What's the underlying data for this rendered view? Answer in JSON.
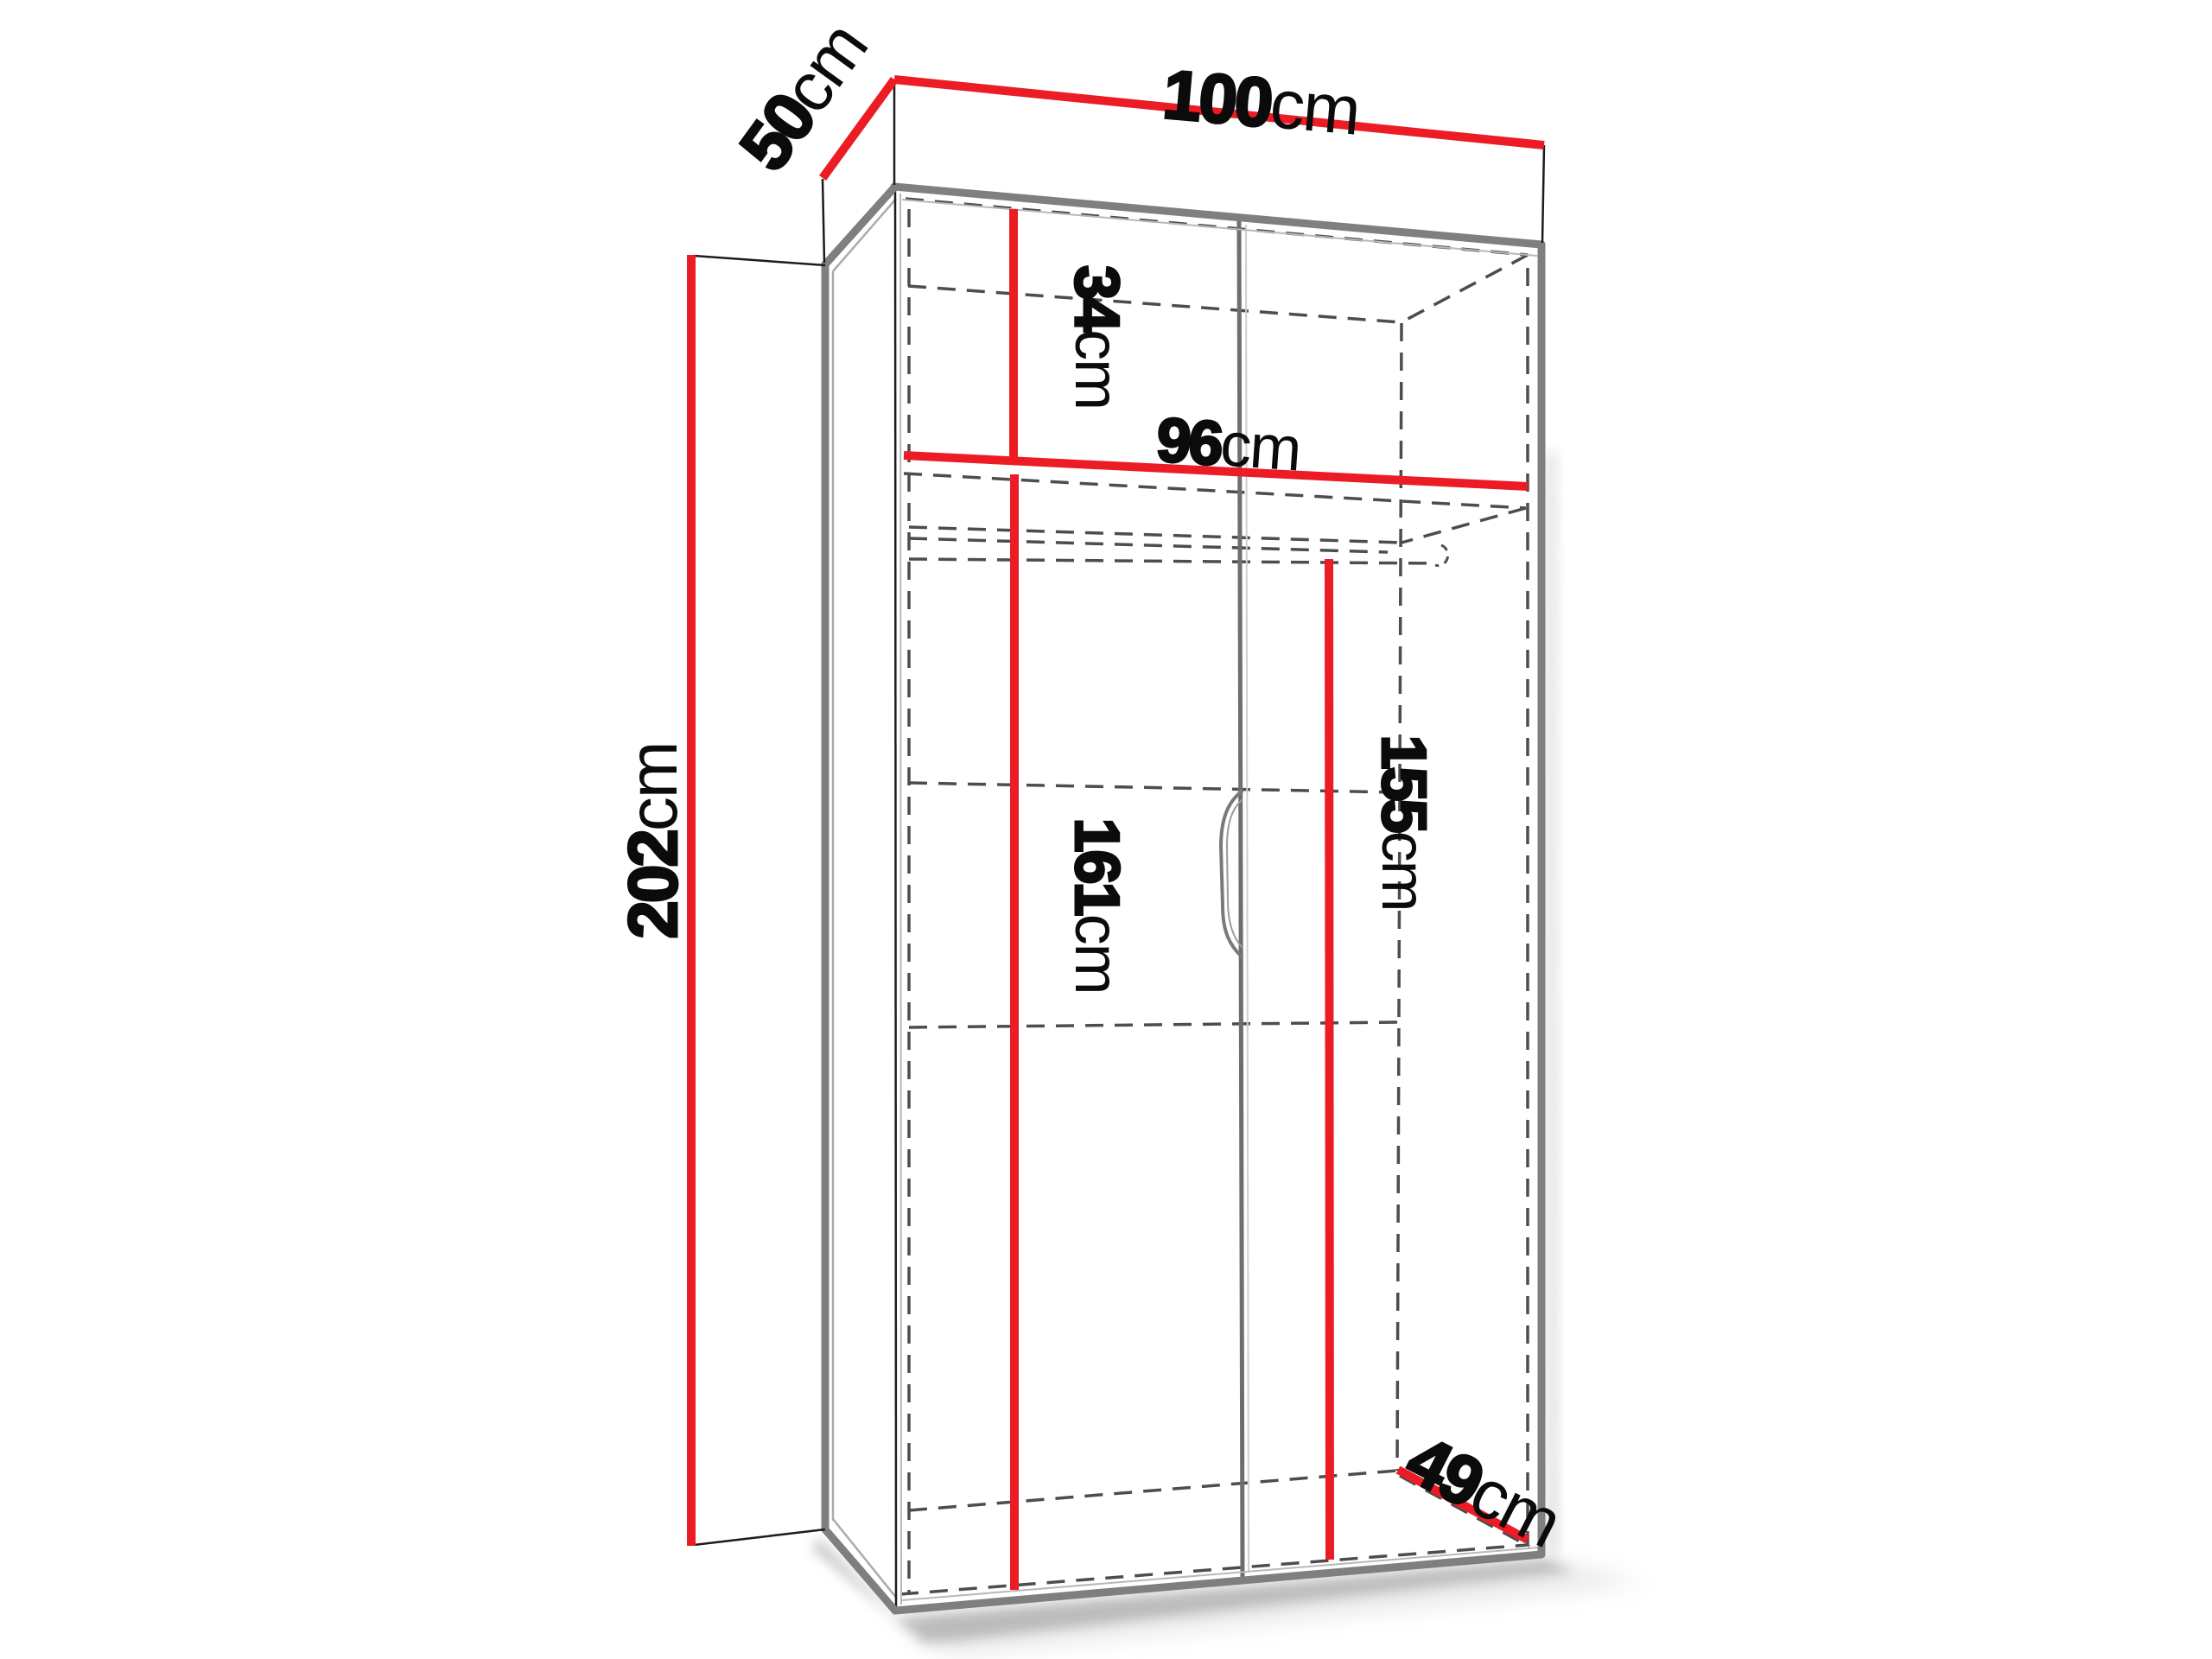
{
  "diagram": {
    "type": "furniture-dimension-diagram",
    "subject": "Two-door wardrobe line drawing in three-quarter perspective with red dimension lines",
    "background_color": "#ffffff",
    "accent_color": "#ec1c24",
    "edge_color": "#7f7f7f",
    "dashed_color": "#4d4d4d",
    "labels": {
      "top_width": {
        "value": "100",
        "unit": "cm"
      },
      "top_depth": {
        "value": "50",
        "unit": "cm"
      },
      "overall_height": {
        "value": "202",
        "unit": "cm"
      },
      "top_section_height": {
        "value": "34",
        "unit": "cm"
      },
      "interior_width": {
        "value": "96",
        "unit": "cm"
      },
      "lower_section_height": {
        "value": "161",
        "unit": "cm"
      },
      "rail_height": {
        "value": "155",
        "unit": "cm"
      },
      "interior_depth": {
        "value": "49",
        "unit": "cm"
      }
    }
  }
}
